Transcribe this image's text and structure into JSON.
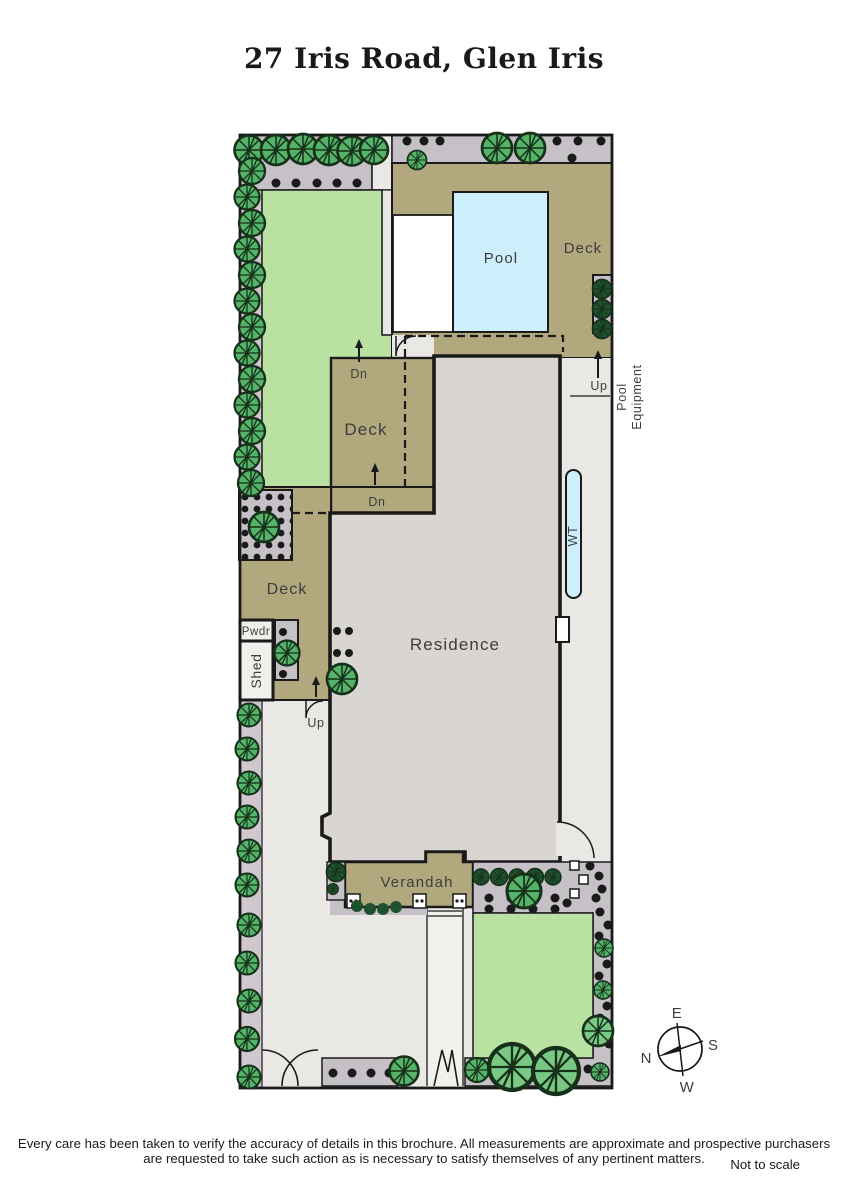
{
  "title": "27 Iris Road, Glen Iris",
  "labels": {
    "pool": "Pool",
    "deck": "Deck",
    "residence": "Residence",
    "verandah": "Verandah",
    "pwdr": "Pwdr",
    "shed": "Shed",
    "water_tank": "WT",
    "pool_equipment_1": "Pool",
    "pool_equipment_2": "Equipment",
    "up": "Up",
    "down": "Dn"
  },
  "compass": {
    "n": "N",
    "e": "E",
    "s": "S",
    "w": "W"
  },
  "footer": {
    "disclaimer_line1": "Every care has been taken to verify the accuracy of details in this brochure.  All measurements are approximate and prospective purchasers",
    "disclaimer_line2": "are requested to take such action as is necessary to satisfy themselves of any pertinent matters.",
    "scale_note": "Not to scale"
  },
  "colors": {
    "line": "#1a1a1a",
    "label": "#3d3d3d",
    "lawn": "#b9e2a2",
    "deck": "#b2a87e",
    "pool": "#cdeefb",
    "residence": "#d9d5d0",
    "path": "#e9e8e5",
    "path_light": "#f1f0ed",
    "bed": "#c6c0c7",
    "strip": "#cfc8cf",
    "tree": "#55b269",
    "tree_light": "#79c883",
    "tree_dark": "#20512e",
    "tree_line": "#163019"
  }
}
